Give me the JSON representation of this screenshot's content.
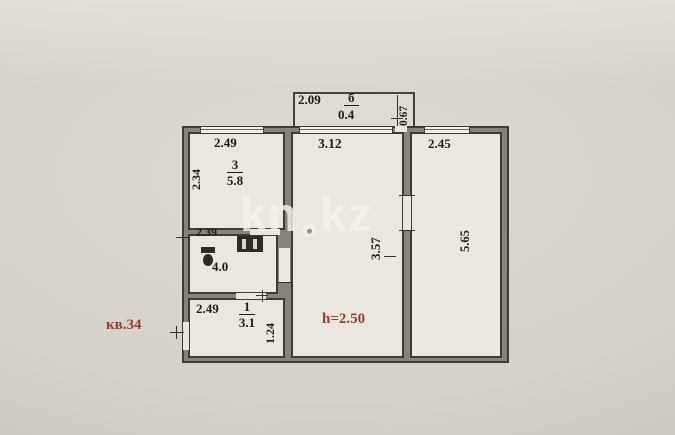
{
  "watermark": {
    "left": "kn",
    "right": "kz"
  },
  "apartment": {
    "label": "кв.34",
    "ceiling_height": "h=2.50"
  },
  "balcony": {
    "width": "2.09",
    "number": "б",
    "area": "0.4",
    "depth": "0.67"
  },
  "room3": {
    "width": "2.49",
    "height": "2.34",
    "number": "3",
    "area": "5.8"
  },
  "bathroom": {
    "width": "2.39",
    "area": "4.0"
  },
  "room1": {
    "width": "2.49",
    "number": "1",
    "area": "3.1",
    "depth": "1.24"
  },
  "living": {
    "width": "3.12",
    "depth": "3.57"
  },
  "bedroom": {
    "width": "2.45",
    "depth": "5.65"
  },
  "colors": {
    "background": "#d5d1c9",
    "wall_fill": "#87827a",
    "wall_edge": "#3e3a35",
    "room_fill": "#eae7e0",
    "dimension_text": "#1f1c18",
    "red_text": "#9a3c30",
    "watermark": "#f4f1e9"
  }
}
